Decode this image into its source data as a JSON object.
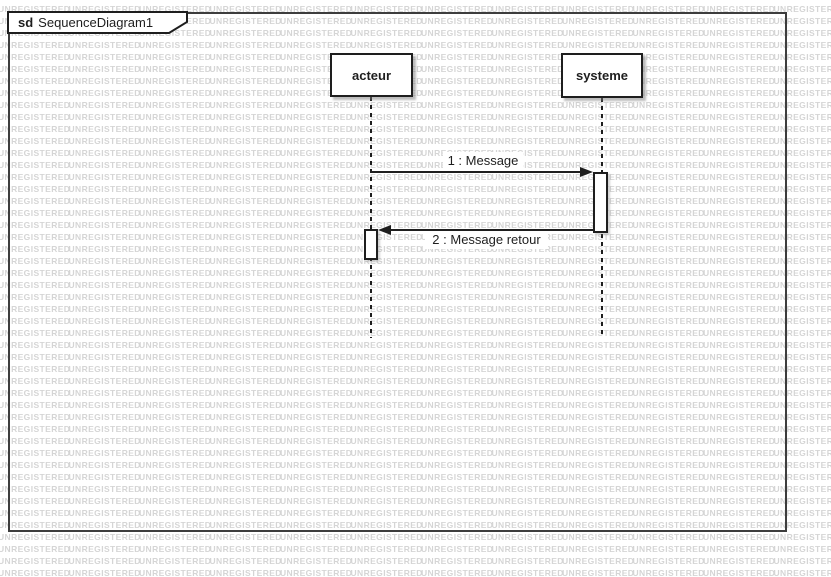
{
  "app": {
    "watermark_text": "UNREGISTERED"
  },
  "frame": {
    "keyword": "sd",
    "title": "SequenceDiagram1"
  },
  "lifelines": [
    {
      "name": "acteur"
    },
    {
      "name": "systeme"
    }
  ],
  "messages": [
    {
      "seq": "1",
      "label": "1 : Message",
      "from": "acteur",
      "to": "systeme",
      "kind": "call"
    },
    {
      "seq": "2",
      "label": "2 : Message retour",
      "from": "systeme",
      "to": "acteur",
      "kind": "return"
    }
  ],
  "colors": {
    "background": "#ffffff",
    "watermark": "#d5d5d5",
    "line": "#1e1e1e",
    "frame-border": "#3d3d3d",
    "shape-fill": "#ffffff",
    "shadow": "#9b9b9b"
  }
}
